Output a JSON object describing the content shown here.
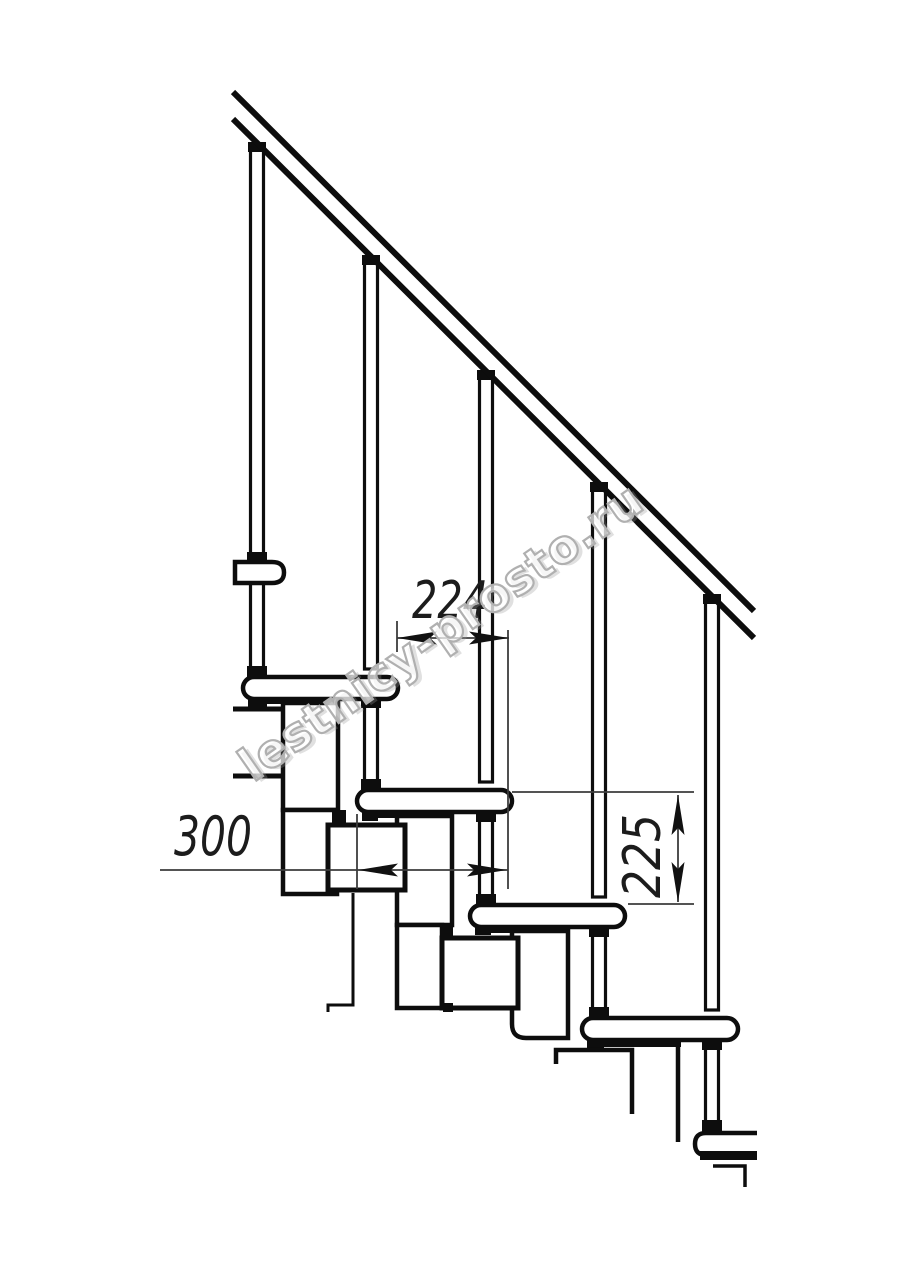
{
  "diagram": {
    "title": "modular staircase side elevation drawing",
    "watermark_text": "lestnicy-prosto.ru",
    "dimensions": {
      "run_label": "224",
      "tread_depth_label": "300",
      "rise_label": "225"
    },
    "colors": {
      "background": "#ffffff",
      "line": "#0d0d0d",
      "dimension_line": "#3c3c3c",
      "watermark_outline": "#b0b0b0"
    },
    "counts": {
      "treads_visible": 5,
      "balusters": 5,
      "support_modules": 4
    }
  }
}
